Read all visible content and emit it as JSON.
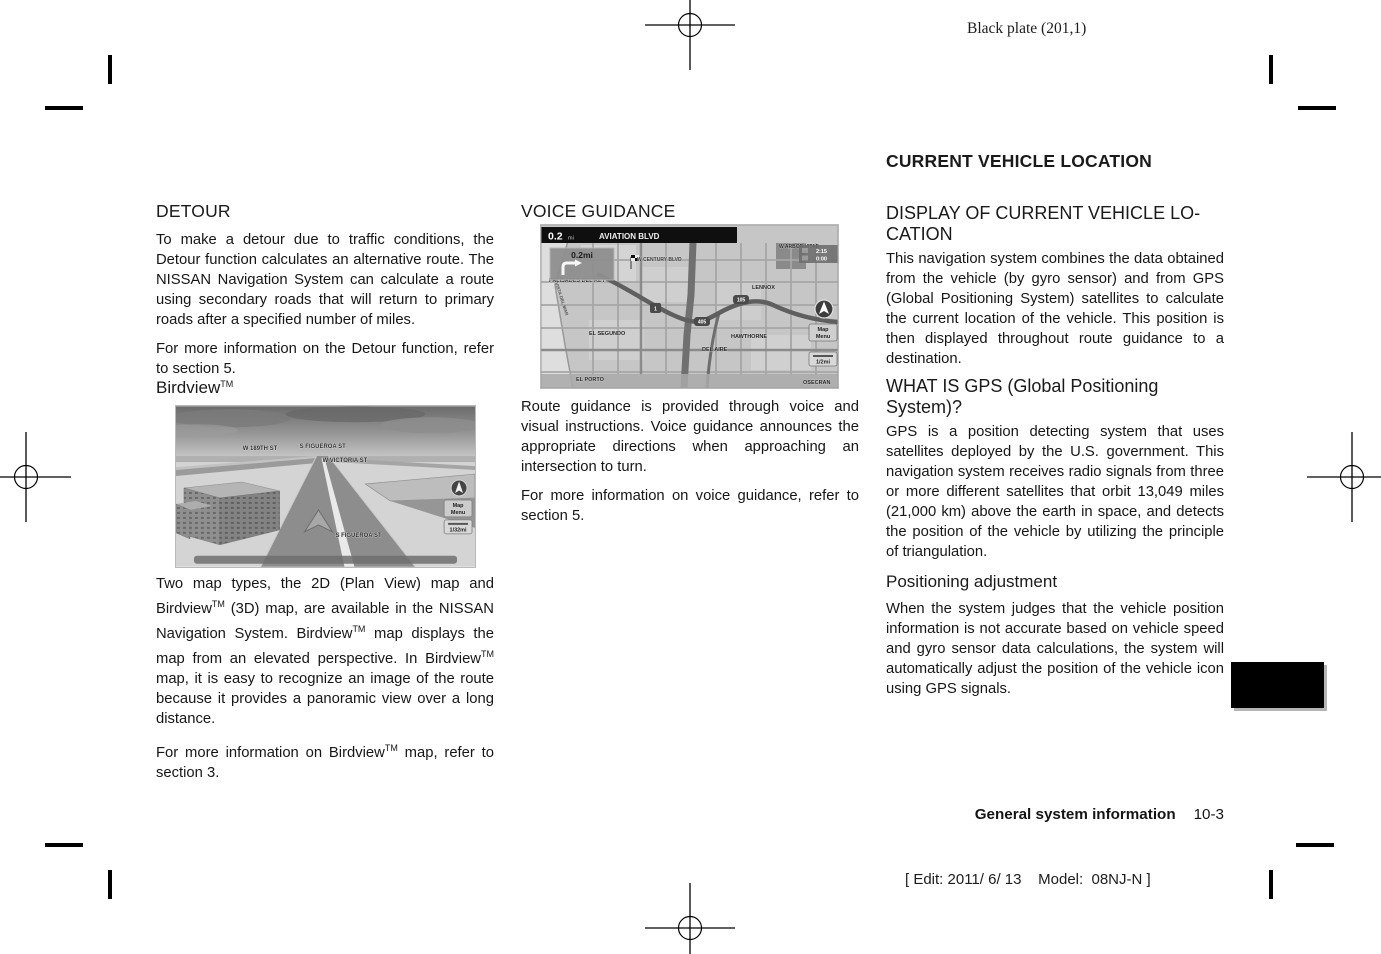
{
  "colors": {
    "paper": "#ffffff",
    "ink": "#141414",
    "tab": "#000000"
  },
  "page": {
    "plate_note": "Black plate (201,1)",
    "footer": {
      "section": "General system information",
      "page_number": "10-3"
    },
    "edit_note": "[ Edit: 2011/ 6/ 13    Model:  08NJ-N ]"
  },
  "left": {
    "detour_heading": "DETOUR",
    "detour_para1": "To make a detour due to traffic conditions, the Detour function calculates an alternative route. The NISSAN Navigation System can calculate a route using secondary roads that will return to primary roads after a specified number of miles.",
    "detour_para2": "For more information on the Detour function, refer to section 5.",
    "birdview_heading": {
      "base": "Birdview",
      "sup": "TM"
    },
    "birdview_para": {
      "s0": "Two map types, the 2D (Plan View) map and Birdview",
      "s1": "TM",
      "s2": " (3D) map, are available in the NISSAN Navigation System. Birdview",
      "s3": "TM",
      "s4": " map displays the map from an elevated perspective. In Birdview",
      "s5": "TM",
      "s6": " map, it is easy to recognize an image of the route because it provides a panoramic view over a long distance."
    },
    "birdview_para2": {
      "s0": "For more information on Birdview",
      "s1": "TM",
      "s2": " map, refer to section 3."
    }
  },
  "middle": {
    "voice_heading": "VOICE GUIDANCE",
    "voice_para1": "Route guidance is provided through voice and visual instructions. Voice guidance announces the appropriate directions when approaching an intersection to turn.",
    "voice_para2": "For more information on voice guidance, refer to section 5."
  },
  "right": {
    "main_heading": "CURRENT VEHICLE LOCATION",
    "display_heading_line1": "DISPLAY OF CURRENT VEHICLE LO-",
    "display_heading_line2": "CATION",
    "display_para": "This navigation system combines the data obtained from the vehicle (by gyro sensor) and from GPS (Global Positioning System) satellites to calculate the current location of the vehicle. This position is then displayed throughout route guidance to a destination.",
    "gps_heading_line1": "WHAT IS GPS (Global Positioning",
    "gps_heading_line2": "System)?",
    "gps_para": "GPS is a position detecting system that uses satellites deployed by the U.S. government. This navigation system receives radio signals from three or more different satellites that orbit 13,049 miles (21,000 km) above the earth in space, and detects the position of the vehicle by utilizing the principle of triangulation.",
    "positioning_heading": "Positioning adjustment",
    "positioning_para": "When the system judges that the vehicle position information is not accurate based on vehicle speed and gyro sensor data calculations, the system will automatically adjust the position of the vehicle icon using GPS signals."
  },
  "birdview_map": {
    "labels": {
      "w189": "W 189TH ST",
      "figueroa_top": "S FIGUEROA ST",
      "victoria": "W VICTORIA ST",
      "figueroa_bottom": "S FIGUEROA ST"
    },
    "buttons": {
      "map_menu_l1": "Map",
      "map_menu_l2": "Menu",
      "scale": "1/32mi"
    }
  },
  "voice_map": {
    "header": {
      "distance": "0.2",
      "unit": "mi",
      "street": "AVIATION BLVD"
    },
    "turn_distance": "0.2mi",
    "eta": "2:15",
    "elapsed": "0:00",
    "shields": {
      "route1": "1",
      "route405": "405",
      "route105": "105"
    },
    "labels": {
      "palisades": "PALISADES DEL REY",
      "century": "W CENTURY BLVD",
      "arbor": "W ARBOR VITAE",
      "lennox": "LENNOX",
      "elsegundo": "EL SEGUNDO",
      "hawthorne": "HAWTHORNE",
      "delaire": "DEL AIRE",
      "elporto": "EL PORTO",
      "rosecran": "OSECRAN",
      "vistadelmar": "VISTA DEL MAR"
    },
    "buttons": {
      "map_menu_l1": "Map",
      "map_menu_l2": "Menu",
      "scale": "1/2mi"
    }
  }
}
